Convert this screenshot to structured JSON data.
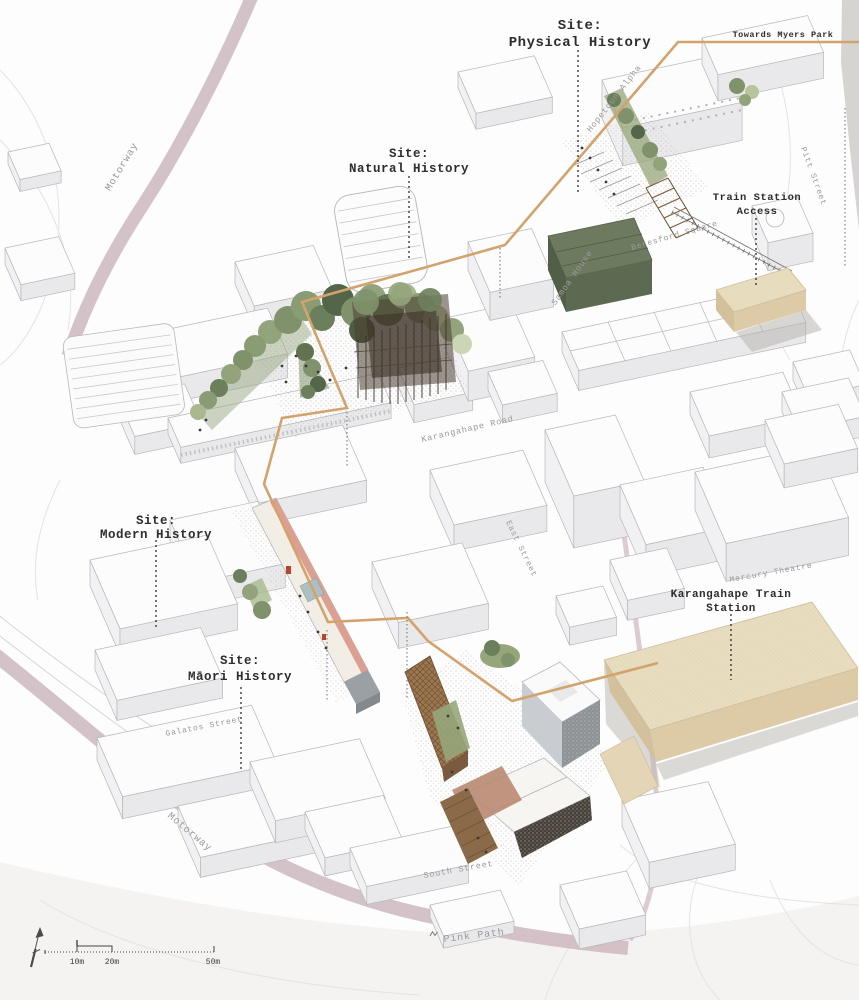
{
  "page": {
    "title": "Site History Masterplan Axonometric"
  },
  "site_labels": {
    "physical": {
      "l1": "Site:",
      "l2": "Physical History"
    },
    "natural": {
      "l1": "Site:",
      "l2": "Natural History"
    },
    "modern": {
      "l1": "Site:",
      "l2": "Modern History"
    },
    "maori": {
      "l1": "Site:",
      "l2": "Māori History"
    }
  },
  "annotations": {
    "towards_myers_park": "Towards Myers Park",
    "train_access": {
      "l1": "Train Station",
      "l2": "Access"
    },
    "train_station": {
      "l1": "Karangahape Train",
      "l2": "Station"
    }
  },
  "streets": {
    "motorway_upper": "Motorway",
    "motorway_lower": "Motorway",
    "hopetoun_alpha": "Hopetoun Alpha",
    "samoa_house": "Samoa House",
    "beresford_square": "Beresford Square",
    "pitt_street": "Pitt Street",
    "karangahape_road": "Karangahape Road",
    "east_street": "East Street",
    "mercury_theatre": "Mercury Theatre",
    "galatos_street": "Galatos Street",
    "south_street": "South Street",
    "pink_path": "Pink Path"
  },
  "scale_bar": {
    "t10": "10m",
    "t20": "20m",
    "t50": "50m"
  },
  "colors": {
    "route": "#d2a36d",
    "station_fill": "#e8dcbe",
    "motorway_pink": "#cdb7bf",
    "park_green": "#7f926b",
    "timber_dark": "#4a3e31",
    "accent_pink": "#dba092"
  }
}
